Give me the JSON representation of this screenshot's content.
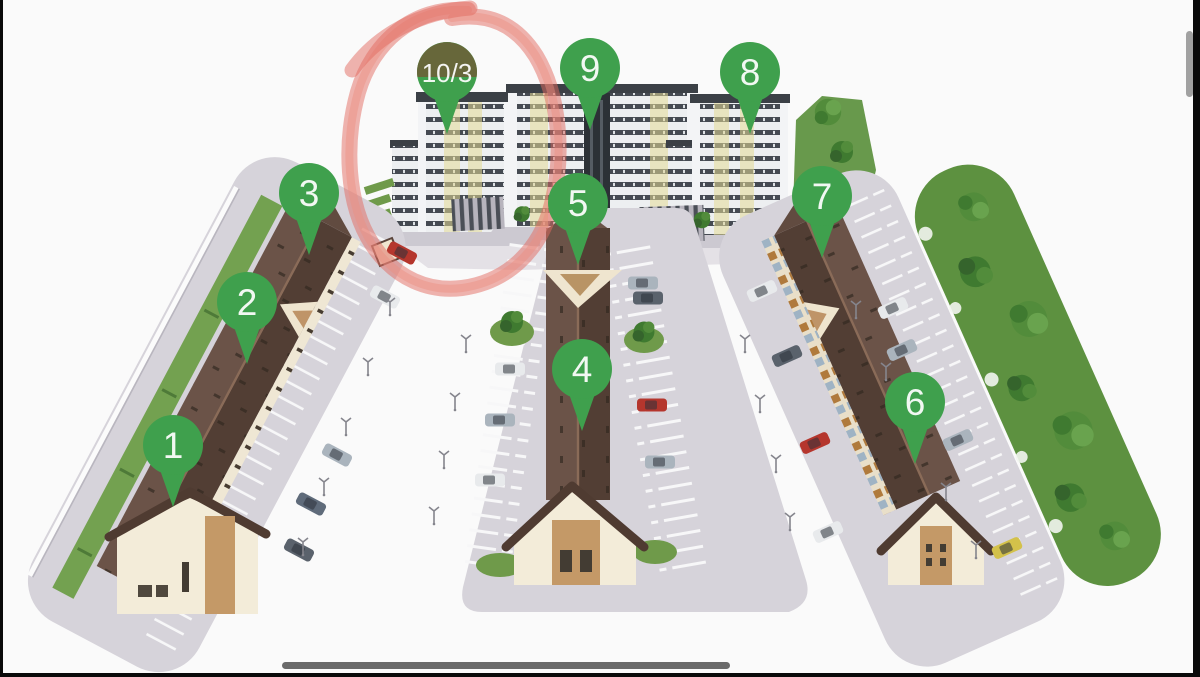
{
  "scene": {
    "description": "3D aerial site plan of a residential complex: three townhouse rows with parking, three apartment towers, tree strip",
    "background_color": "#fafafa"
  },
  "markers": [
    {
      "label": "1"
    },
    {
      "label": "2"
    },
    {
      "label": "3"
    },
    {
      "label": "4"
    },
    {
      "label": "5"
    },
    {
      "label": "6"
    },
    {
      "label": "7"
    },
    {
      "label": "8"
    },
    {
      "label": "9"
    },
    {
      "label": "10/3",
      "highlighted": true
    }
  ],
  "annotation": {
    "type": "hand-drawn-circle",
    "target_marker": "10/3",
    "color": "#e2695e"
  },
  "colors": {
    "marker_green": "#3fa04d",
    "marker_text": "#ffffff",
    "roof_brown": "#5d473c",
    "facade_cream": "#f3ecd9",
    "brick": "#c49967",
    "parking_gray": "#d6d3da",
    "lawn_green": "#6f9a4a",
    "tower_band": "#454a52",
    "tower_yellow": "#e3da96",
    "annotation_red": "#e2695e",
    "divider_gray": "#6a6a6a"
  },
  "ui": {
    "scrollbar_visible": true,
    "bottom_divider_visible": true
  }
}
